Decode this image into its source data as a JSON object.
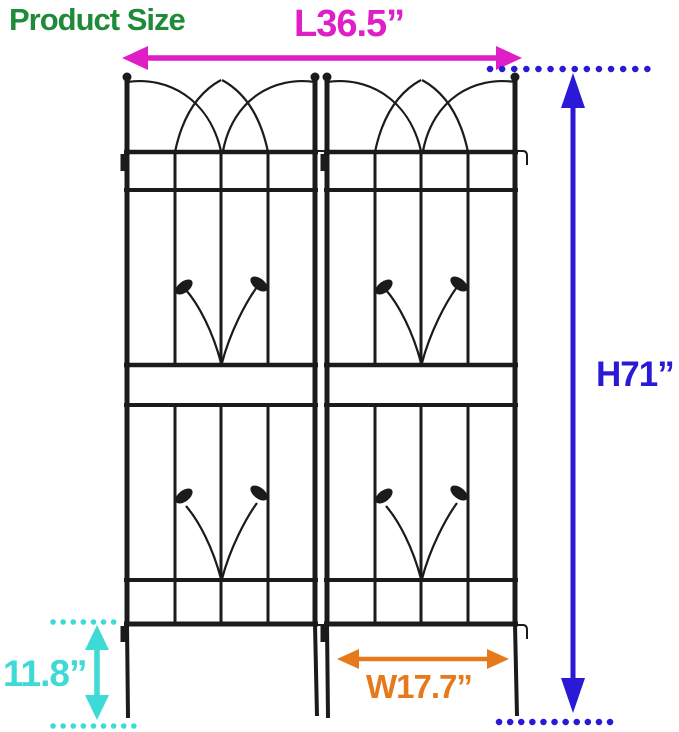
{
  "title": "Product Size",
  "colors": {
    "title": "#1f8a3a",
    "length": "#df1ec6",
    "height": "#2a1ad6",
    "ground": "#3edad6",
    "width": "#e7791d",
    "frame": "#1b1b1b",
    "background": "#ffffff"
  },
  "dimensions": {
    "length": {
      "label": "L36.5”"
    },
    "height": {
      "label": "H71”"
    },
    "ground_clearance": {
      "label": "11.8”"
    },
    "panel_width": {
      "label": "W17.7”"
    }
  }
}
